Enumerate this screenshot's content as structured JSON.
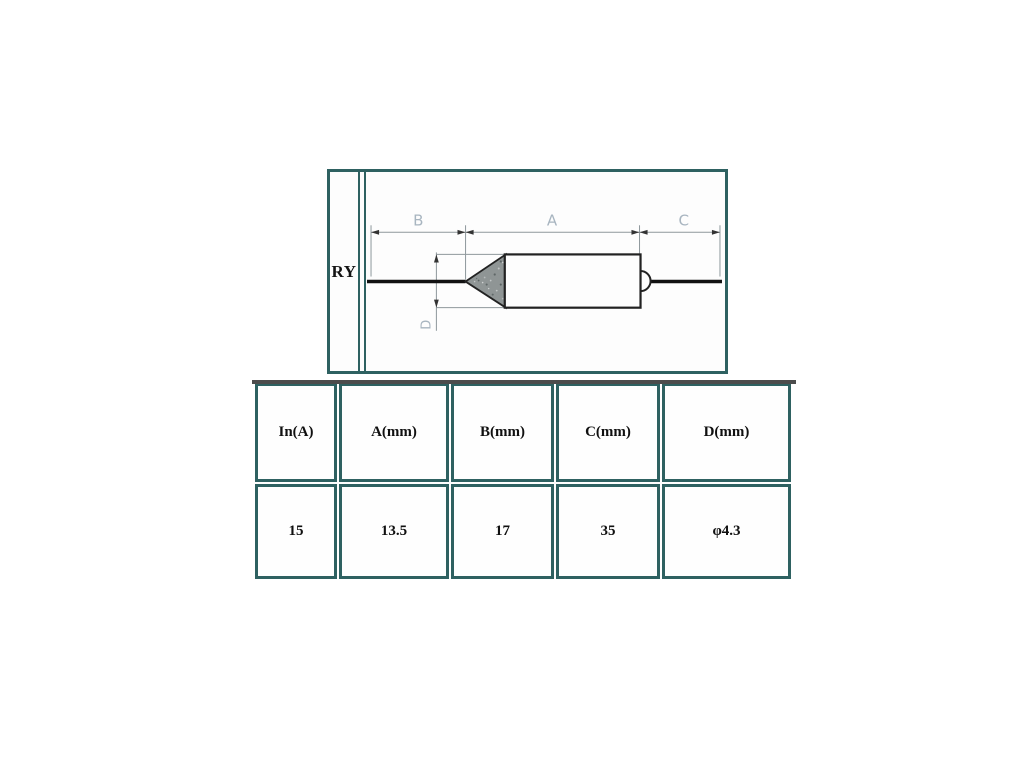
{
  "diagram": {
    "label": "RY",
    "dims": {
      "a": "A",
      "b": "B",
      "c": "C",
      "d": "D"
    }
  },
  "table": {
    "headers": [
      "In(A)",
      "A(mm)",
      "B(mm)",
      "C(mm)",
      "D(mm)"
    ],
    "rows": [
      [
        "15",
        "13.5",
        "17",
        "35",
        "φ4.3"
      ]
    ]
  },
  "colors": {
    "frame_border": "#2e6161",
    "table_top_line": "#4c4c4c",
    "dimension_line": "#8f989c",
    "dimension_label": "#a8b5c0",
    "component_stroke": "#1c1c1c",
    "cone_fill": "#8f9595"
  }
}
